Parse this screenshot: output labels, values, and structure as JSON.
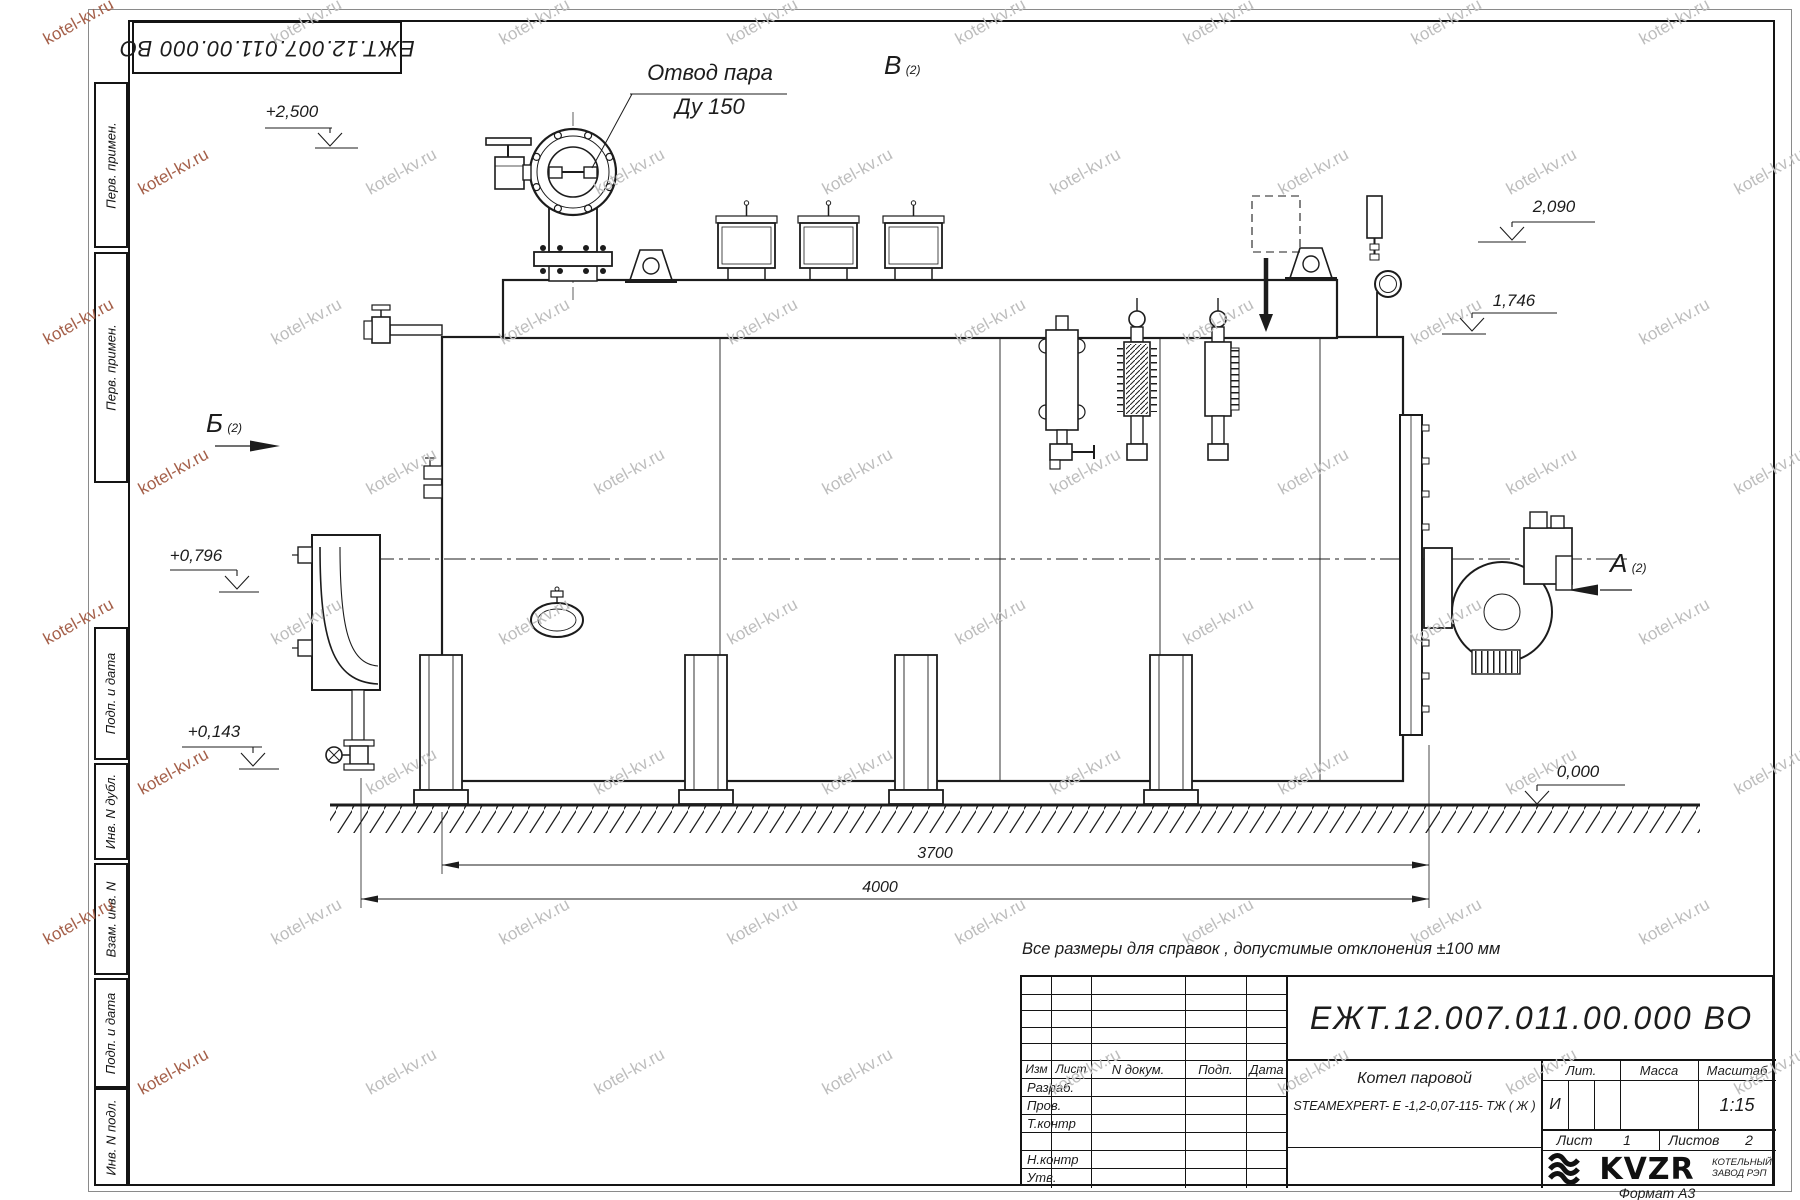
{
  "watermark": {
    "text": "kotel-kv.ru"
  },
  "stamp_top": {
    "designation": "ЕЖТ.12.007.011.00.000 ВО"
  },
  "sidebar": {
    "cells": [
      {
        "label": "Перв. примен."
      },
      {
        "label": "Перв. примен."
      },
      {
        "label": "Подп. и дата"
      },
      {
        "label": "Инв. N дубл."
      },
      {
        "label": "Взам. инв. N"
      },
      {
        "label": "Подп. и дата"
      },
      {
        "label": "Инв. N подл."
      }
    ]
  },
  "annotations": {
    "steam_outlet_line1": "Отвод пара",
    "steam_outlet_line2": "Ду 150",
    "view_b": "В",
    "view_b_sub": "(2)",
    "view_bb": "Б",
    "view_bb_sub": "(2)",
    "view_a": "А",
    "view_a_sub": "(2)",
    "elev_top": "+2,500",
    "elev_2090": "2,090",
    "elev_1746": "1,746",
    "elev_0796": "+0,796",
    "elev_0143": "+0,143",
    "elev_zero": "0,000",
    "dim_3700": "3700",
    "dim_4000": "4000",
    "note": "Все размеры для справок , допустимые отклонения ±100 мм"
  },
  "title_block": {
    "designation": "ЕЖТ.12.007.011.00.000  ВО",
    "doc_header": {
      "izm": "Изм",
      "list": "Лист",
      "n_dokum": "N докум.",
      "podp": "Подп.",
      "data": "Дата"
    },
    "rows": [
      "Разраб.",
      "Пров.",
      "Т.контр",
      "",
      "Н.контр",
      "Утв."
    ],
    "product_name_line1": "Котел паровой",
    "product_name_line2": "STEAMEXPERT- Е -1,2-0,07-115- ТЖ ( Ж )",
    "lit_header": "Лит.",
    "massa_header": "Масса",
    "masshtab_header": "Масштаб",
    "lit_value": "И",
    "masshtab_value": "1:15",
    "list_label": "Лист",
    "list_value": "1",
    "listov_label": "Листов",
    "listov_value": "2",
    "logo_text": "KVZR",
    "logo_caption_line1": "КОТЕЛЬНЫЙ",
    "logo_caption_line2": "ЗАВОД РЭП",
    "format_label": "Формат А3"
  }
}
